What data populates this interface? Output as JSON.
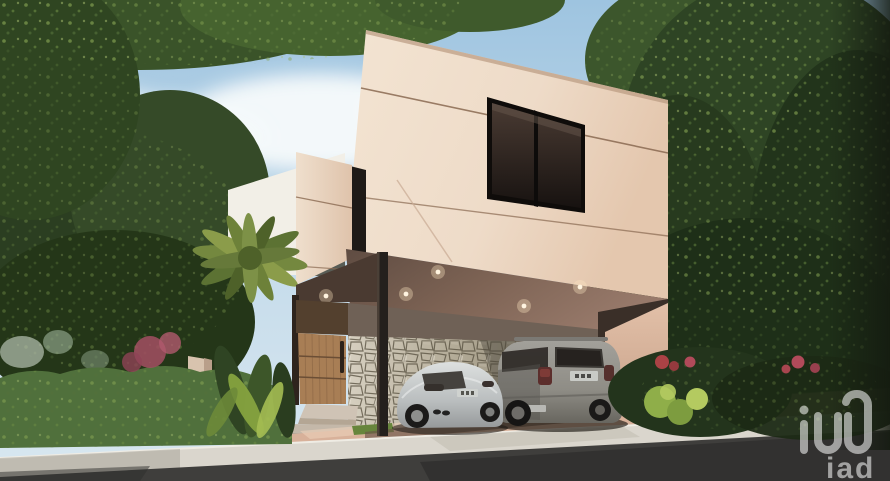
{
  "meta": {
    "kind": "architectural-exterior-rendering",
    "description": "3D render of a modern two-story beige house with cantilevered upper volume, carport with two cars, stone accent wall, wooden entry door, lush tropical landscaping, street in foreground, partly cloudy sky"
  },
  "watermark": {
    "text": "iad",
    "logo_icon": "iad-monogram-icon",
    "color": "#ffffff",
    "opacity": 0.55,
    "position": "bottom-right"
  },
  "house": {
    "style": "modern minimalist",
    "floors": 2,
    "facade_color_name": "cream beige stucco",
    "features": [
      "cantilevered upper volume",
      "large dark-framed two-pane window",
      "narrow dark vertical window slot",
      "stepped secondary volume",
      "carport with recessed downlights",
      "stone mosaic accent wall",
      "vertical-slat wooden entry door with long handle",
      "slim dark steel column",
      "two concrete entry steps"
    ],
    "downlight_count": 5
  },
  "vehicles": [
    {
      "kind": "sports coupe",
      "color": "silver",
      "position": "left under carport",
      "license_plate": "illegible"
    },
    {
      "kind": "SUV",
      "color": "grey",
      "position": "right under carport",
      "license_plate": "illegible"
    }
  ],
  "environment": {
    "sky": "blue with white clouds",
    "vegetation": [
      "overhanging branches top-left",
      "dense trees left",
      "large trees right",
      "palm tree",
      "green hedge",
      "pink bougainvillea",
      "red flowering shrubs",
      "tropical leaf plants",
      "silvery plants"
    ],
    "street": [
      "pink paver driveway",
      "white concrete curb sidewalk",
      "dark asphalt road with tree shadows"
    ]
  },
  "palette": {
    "sky_top": "#9ec4e0",
    "sky_low": "#d8e7f0",
    "cloud": "#f7fafb",
    "facade_light": "#eedbc8",
    "facade_shaded": "#ddbba4",
    "carport_ceiling": "#8a6c5c",
    "soffit_dark": "#4a3a31",
    "stone_light": "#d6cfc0",
    "stone_shaded": "#877f6e",
    "wood_door": "#a87e55",
    "wood_dark": "#53402e",
    "window_glass": "#221a16",
    "column_dark": "#24201d",
    "foliage_dark": "#263a1e",
    "foliage_mid": "#3c562c",
    "foliage_light": "#86a452",
    "hedge": "#50703c",
    "flower_pink": "#a34f63",
    "flower_red": "#ab4245",
    "driveway": "#d8b19a",
    "curb": "#dad6cd",
    "road": "#3f3e3c",
    "car_coupe": "#c2c6c7",
    "car_suv": "#8f8d86",
    "downlight": "#fff4e0",
    "watermark": "#ffffff"
  }
}
